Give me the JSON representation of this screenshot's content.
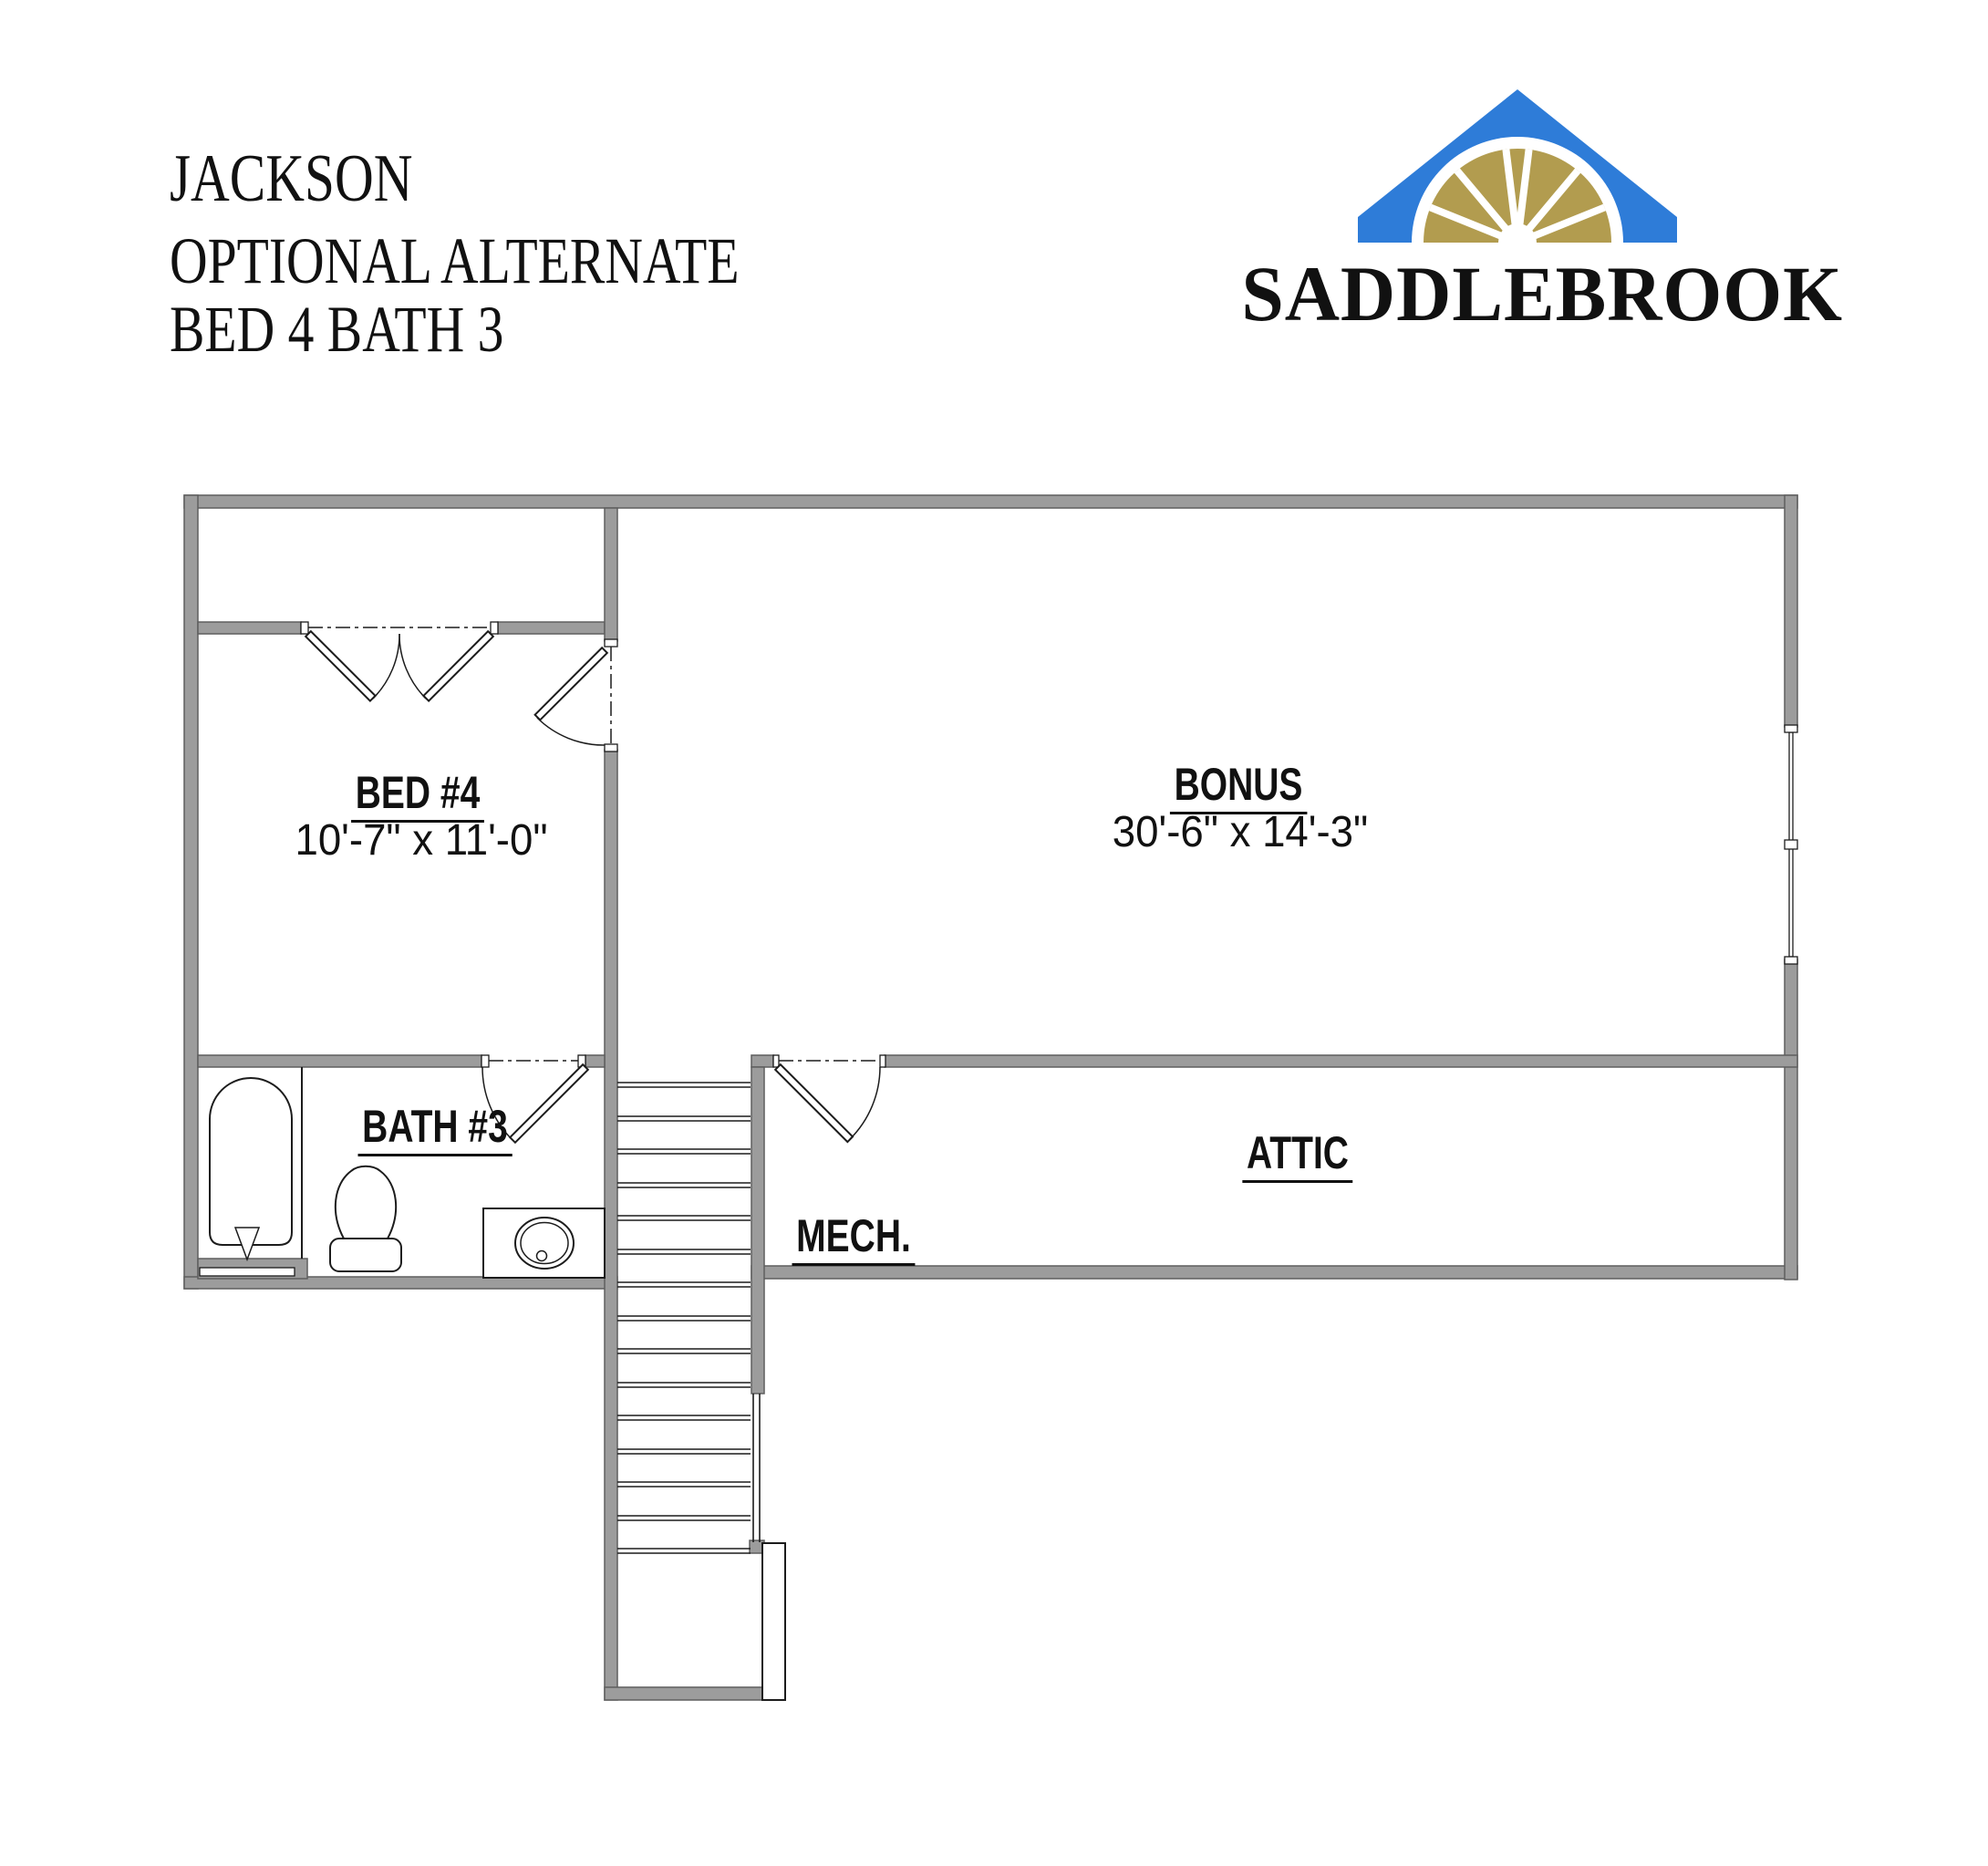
{
  "title": {
    "project": "JACKSON",
    "line2": "OPTIONAL ALTERNATE",
    "line3": "BED 4 BATH 3"
  },
  "logo": {
    "brand": "SADDLEBROOK",
    "colors": {
      "roof_blue": "#2E7CD8",
      "fan_gold": "#B29C4F",
      "brand_text": "#111111"
    }
  },
  "plan": {
    "colors": {
      "wall_fill": "#9C9C9C",
      "wall_edge": "#5E5E5E",
      "line": "#1C1C1C"
    },
    "rooms": [
      {
        "id": "bed4",
        "label": "BED #4",
        "dims": "10'-7\" x 11'-0\""
      },
      {
        "id": "bonus",
        "label": "BONUS",
        "dims": "30'-6\" x 14'-3\""
      },
      {
        "id": "bath3",
        "label": "BATH #3"
      },
      {
        "id": "attic",
        "label": "ATTIC"
      },
      {
        "id": "mech",
        "label": "MECH."
      }
    ]
  }
}
